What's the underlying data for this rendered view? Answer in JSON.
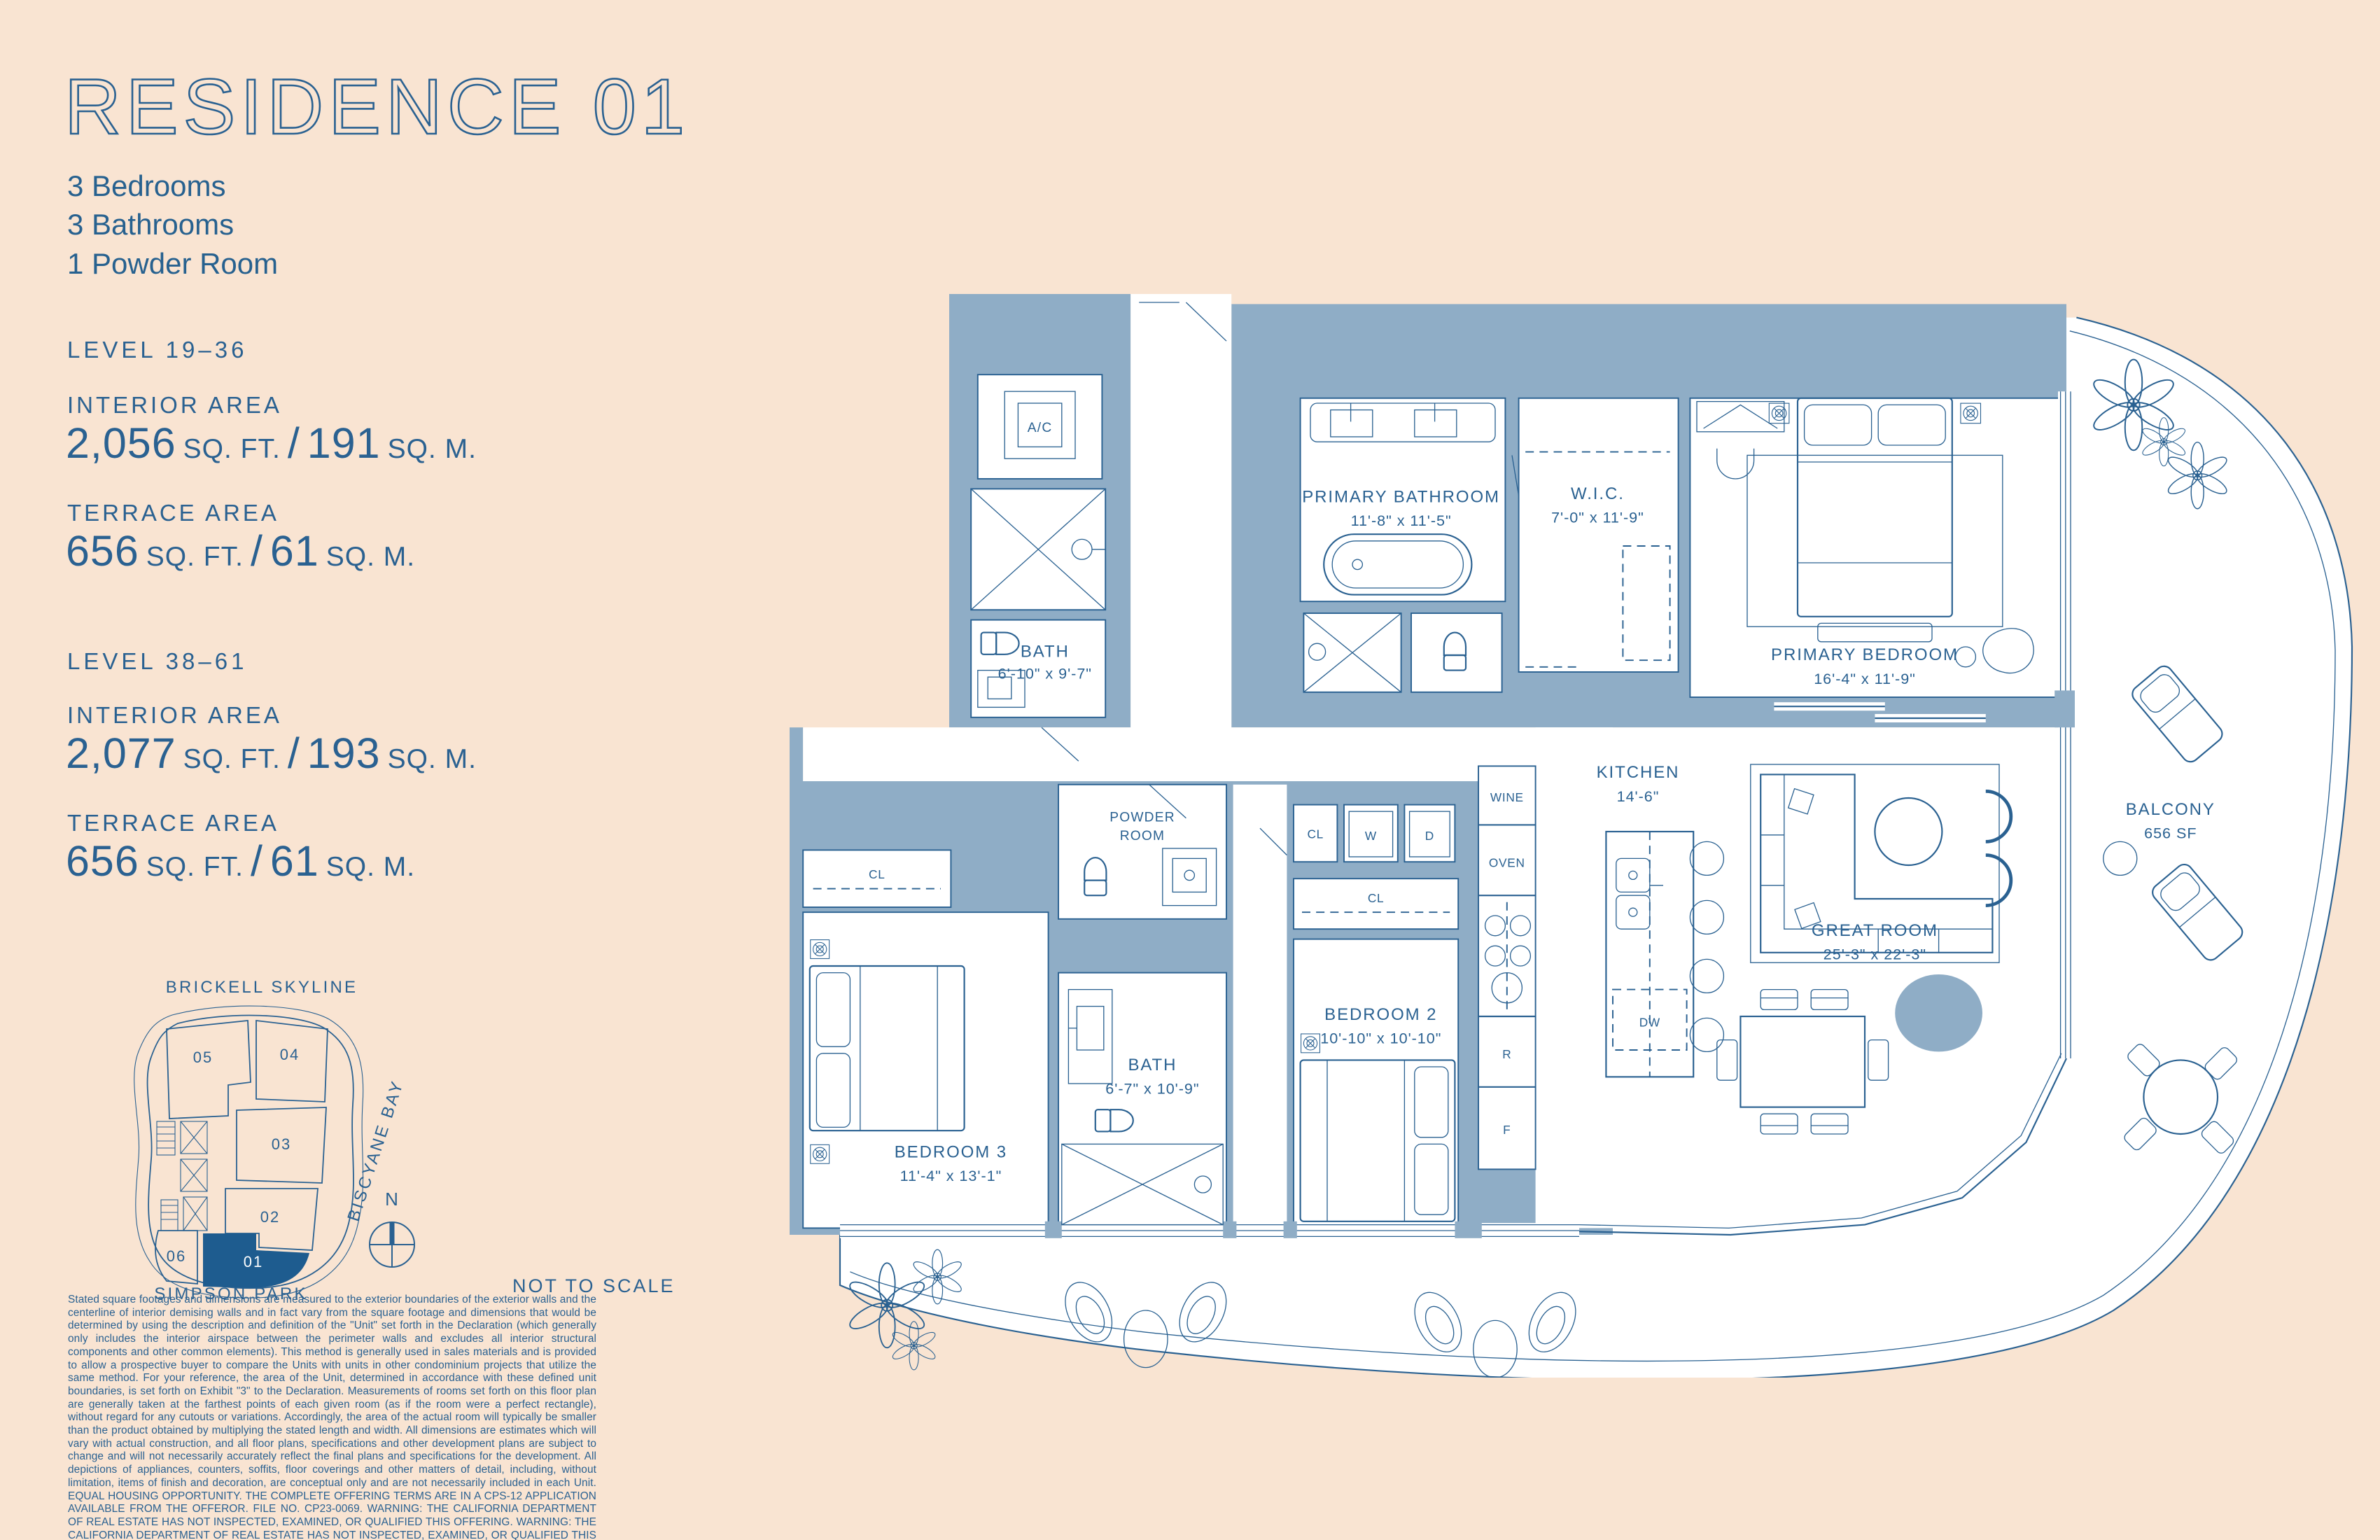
{
  "colors": {
    "background": "#F9E4D2",
    "ink": "#2A6191",
    "wall": "#8FADC6",
    "highlight_unit": "#1E5C8F"
  },
  "header": {
    "title": "RESIDENCE 01",
    "features": [
      "3 Bedrooms",
      "3 Bathrooms",
      "1 Powder Room"
    ]
  },
  "misc": {
    "separator": "/"
  },
  "levels": [
    {
      "name": "LEVEL 19–36",
      "areas": [
        {
          "label": "INTERIOR AREA",
          "imp": "2,056",
          "impUnit": "SQ. FT.",
          "sep": "/",
          "met": "191",
          "metUnit": "SQ. M."
        },
        {
          "label": "TERRACE AREA",
          "imp": "656",
          "impUnit": "SQ. FT.",
          "sep": "/",
          "met": "61",
          "metUnit": "SQ. M."
        }
      ]
    },
    {
      "name": "LEVEL 38–61",
      "areas": [
        {
          "label": "INTERIOR AREA",
          "imp": "2,077",
          "impUnit": "SQ. FT.",
          "sep": "/",
          "met": "193",
          "metUnit": "SQ. M."
        },
        {
          "label": "TERRACE AREA",
          "imp": "656",
          "impUnit": "SQ. FT.",
          "sep": "/",
          "met": "61",
          "metUnit": "SQ. M."
        }
      ]
    }
  ],
  "keyplan": {
    "skyline": "BRICKELL SKYLINE",
    "bay": "BISCYANE BAY",
    "park": "SIMPSON PARK",
    "units": [
      "05",
      "04",
      "03",
      "02",
      "01",
      "06"
    ],
    "highlighted_unit": "01"
  },
  "compass": {
    "n": "N"
  },
  "scale_note": "NOT TO SCALE",
  "disclaimer": "Stated square footages and dimensions are measured to the exterior boundaries of the exterior walls and the centerline of interior demising walls and in fact vary from the square footage and dimensions that would be determined by using the description and definition of the \"Unit\" set forth in the Declaration (which generally only includes the interior airspace between the perimeter walls and excludes all interior structural components and other common elements). This method is generally used in sales materials and is provided to allow a prospective buyer to compare the Units with units in other condominium projects that utilize the same method. For your reference, the area of the Unit, determined in accordance with these defined unit boundaries, is set forth on Exhibit \"3\" to the Declaration. Measurements of rooms set forth on this floor plan are generally taken at the farthest points of each given room (as if the room were a perfect rectangle), without regard for any cutouts or variations. Accordingly, the area of the actual room will typically be smaller than the product obtained by multiplying the stated length and width.  All dimensions are estimates which will vary with actual construction, and all floor plans, specifications and other development plans are subject to change and will not necessarily accurately reflect the final plans and specifications for the development. All depictions of appliances, counters, soffits, floor coverings and other matters of detail, including, without limitation, items of finish and decoration, are conceptual only and are not necessarily included in each Unit. EQUAL HOUSING OPPORTUNITY. THE COMPLETE OFFERING TERMS ARE IN A CPS-12 APPLICATION AVAILABLE FROM THE OFFEROR. FILE NO. CP23-0069. WARNING: THE CALIFORNIA DEPARTMENT OF REAL ESTATE HAS NOT INSPECTED, EXAMINED, OR QUALIFIED THIS OFFERING. WARNING: THE CALIFORNIA DEPARTMENT OF REAL ESTATE HAS NOT INSPECTED, EXAMINED, OR QUALIFIED THIS OFFERING. This advertisement is a solicitation for the sale of Units in 1420 S. Miami Avenue Condominium & N.J. Registration No. 24-04-0005.",
  "floorplan": {
    "rooms": {
      "ac": {
        "name": "A/C"
      },
      "bath3": {
        "name": "BATH",
        "dims": "6'-10\" x 9'-7\""
      },
      "primary_bathroom": {
        "name": "PRIMARY BATHROOM",
        "dims": "11'-8\" x 11'-5\""
      },
      "wic": {
        "name": "W.I.C.",
        "dims": "7'-0\" x 11'-9\""
      },
      "primary_bedroom": {
        "name": "PRIMARY BEDROOM",
        "dims": "16'-4\" x 11'-9\""
      },
      "great_room": {
        "name": "GREAT ROOM",
        "dims": "25'-3\" x 22'-3\""
      },
      "kitchen": {
        "name": "KITCHEN",
        "dims": "14'-6\""
      },
      "powder_room": {
        "line1": "POWDER",
        "line2": "ROOM"
      },
      "bath2": {
        "name": "BATH",
        "dims": "6'-7\" x 10'-9\""
      },
      "bedroom2": {
        "name": "BEDROOM 2",
        "dims": "10'-10\" x 10'-10\""
      },
      "bedroom3": {
        "name": "BEDROOM 3",
        "dims": "11'-4\" x 13'-1\""
      },
      "balcony": {
        "name": "BALCONY",
        "dims": "656 SF"
      }
    },
    "fixtures": {
      "wine": "WINE",
      "oven": "OVEN",
      "fridge": "R",
      "freezer": "F",
      "dishwasher": "DW",
      "washer": "W",
      "dryer": "D",
      "closet": "CL"
    }
  }
}
